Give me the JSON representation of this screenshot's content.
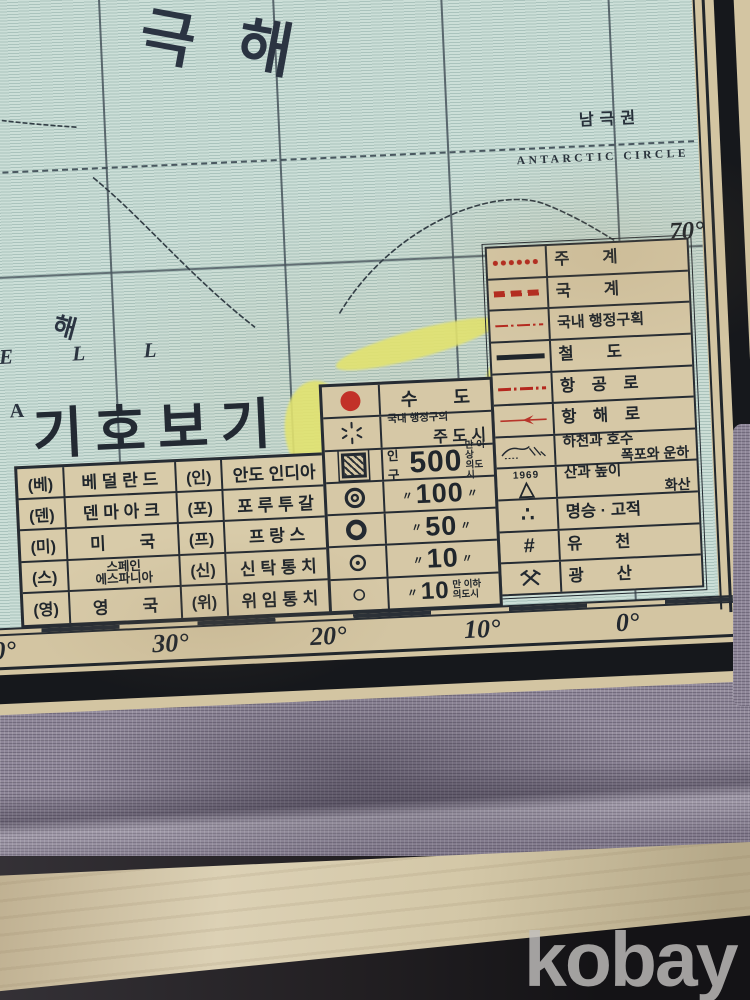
{
  "watermark": "kobay",
  "map": {
    "sea_chars": {
      "partial": "남",
      "c1": "극",
      "c2": "해"
    },
    "antarctic": {
      "kr": "남극권",
      "en": "ANTARCTIC CIRCLE"
    },
    "lat_label": "70°",
    "small_sea": "해",
    "sea_serif_letters": "E L L",
    "letter_a": "A",
    "legend_title": "기호보기",
    "lon_labels": {
      "l40": "0°",
      "l30": "30°",
      "l20": "20°",
      "l10": "10°",
      "l0": "0°"
    },
    "symbol_rows": [
      {
        "label": "주　　계"
      },
      {
        "label": "국　　계"
      },
      {
        "label": "국내 행정구획"
      },
      {
        "label": "철　　도"
      },
      {
        "label": "항　공　로"
      },
      {
        "label": "항　해　로"
      },
      {
        "label": "하천과 호수",
        "label2": "폭포와 운하"
      },
      {
        "label": "산과 높이",
        "label2": "화산",
        "note": "1969"
      },
      {
        "label": "명승 · 고적"
      },
      {
        "label": "유　　천"
      },
      {
        "label": "광　　산"
      }
    ],
    "country_rows": [
      {
        "a1": "(베)",
        "n1": "베 덜 란 드",
        "a2": "(인)",
        "n2": "안도 인디아"
      },
      {
        "a1": "(덴)",
        "n1": "덴 마 아 크",
        "a2": "(포)",
        "n2": "포 루 투 갈"
      },
      {
        "a1": "(미)",
        "n1": "미　　국",
        "a2": "(프)",
        "n2": "프 랑 스"
      },
      {
        "a1": "(스)",
        "n1a": "스페인",
        "n1b": "에스파니아",
        "a2": "(신)",
        "n2": "신 탁 통 치"
      },
      {
        "a1": "(영)",
        "n1": "영　　국",
        "a2": "(위)",
        "n2": "위 임 통 치"
      }
    ],
    "city_rows": {
      "capital": {
        "text": "수　　도"
      },
      "province": {
        "small": "국내 행정구의",
        "main": "주 도 시"
      },
      "m500": {
        "pre": "인구",
        "num": "500",
        "suf1": "만 이상",
        "suf2": "의도시"
      },
      "m100": {
        "d1": "〃",
        "num": "100",
        "d2": "〃"
      },
      "m50": {
        "d1": "〃",
        "num": "50",
        "d2": "〃"
      },
      "m10": {
        "d1": "〃",
        "num": "10",
        "d2": "〃"
      },
      "m10under": {
        "d1": "〃",
        "num": "10",
        "suf1": "만 이하",
        "suf2": "의도시"
      }
    }
  }
}
